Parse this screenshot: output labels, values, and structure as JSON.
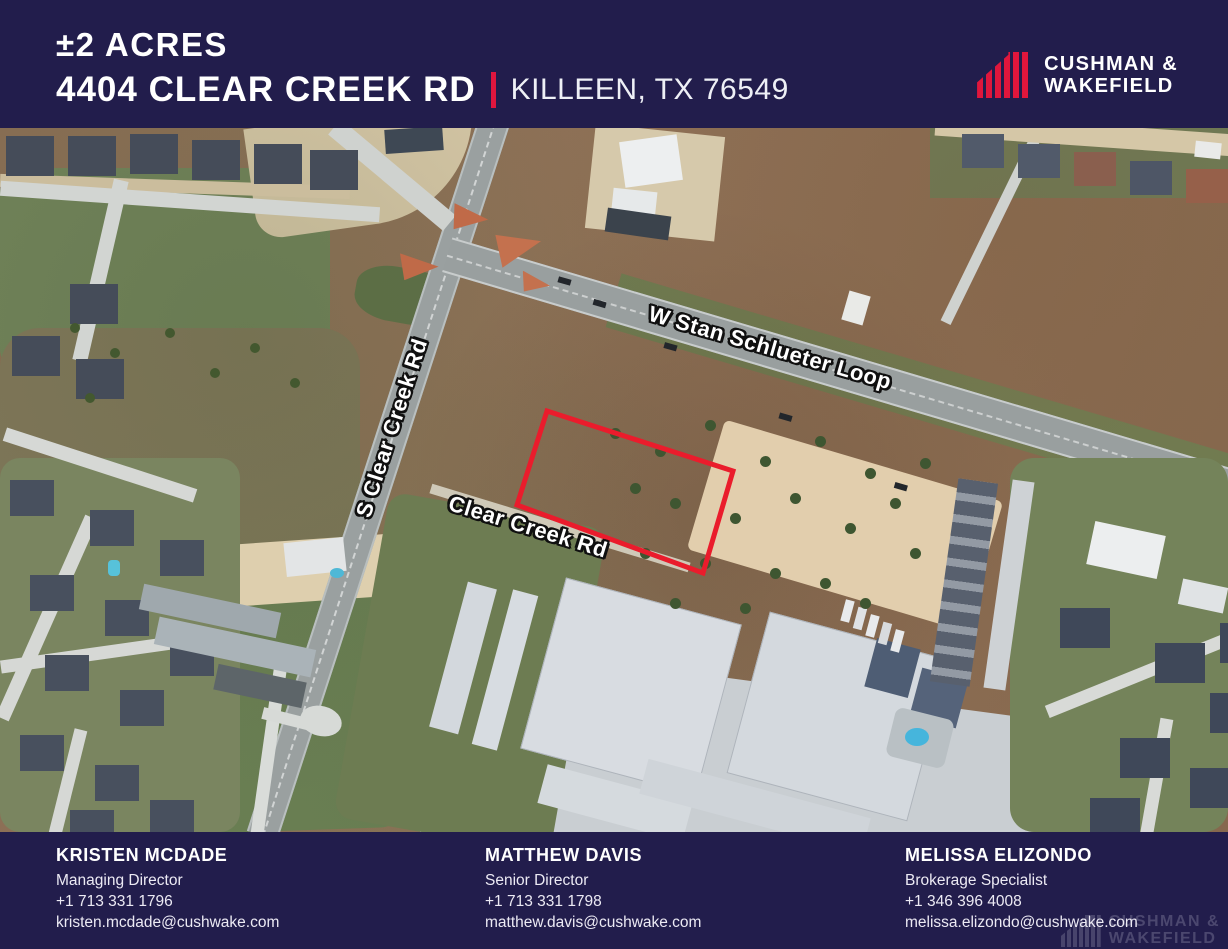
{
  "header": {
    "acreage": "±2 ACRES",
    "address": "4404 CLEAR CREEK RD",
    "location": "KILLEEN, TX 76549",
    "brand": {
      "line1": "CUSHMAN &",
      "line2": "WAKEFIELD"
    }
  },
  "map": {
    "type": "satellite-aerial",
    "road_labels": [
      {
        "label": "W Stan Schlueter Loop"
      },
      {
        "label": "S Clear Creek Rd"
      },
      {
        "label": "Clear Creek Rd"
      }
    ],
    "parcel": {
      "outline_color": "#ea1c2c"
    }
  },
  "footer": {
    "contacts": [
      {
        "name": "KRISTEN MCDADE",
        "title": "Managing Director",
        "phone": "+1 713 331 1796",
        "email": "kristen.mcdade@cushwake.com"
      },
      {
        "name": "MATTHEW DAVIS",
        "title": "Senior Director",
        "phone": "+1 713 331 1798",
        "email": "matthew.davis@cushwake.com"
      },
      {
        "name": "MELISSA ELIZONDO",
        "title": "Brokerage Specialist",
        "phone": "+1 346 396 4008",
        "email": "melissa.elizondo@cushwake.com"
      }
    ],
    "watermark": {
      "line1": "CUSHMAN &",
      "line2": "WAKEFIELD"
    }
  },
  "colors": {
    "navy": "#221d4c",
    "brand_red": "#e0163c",
    "parcel_red": "#ea1c2c"
  }
}
